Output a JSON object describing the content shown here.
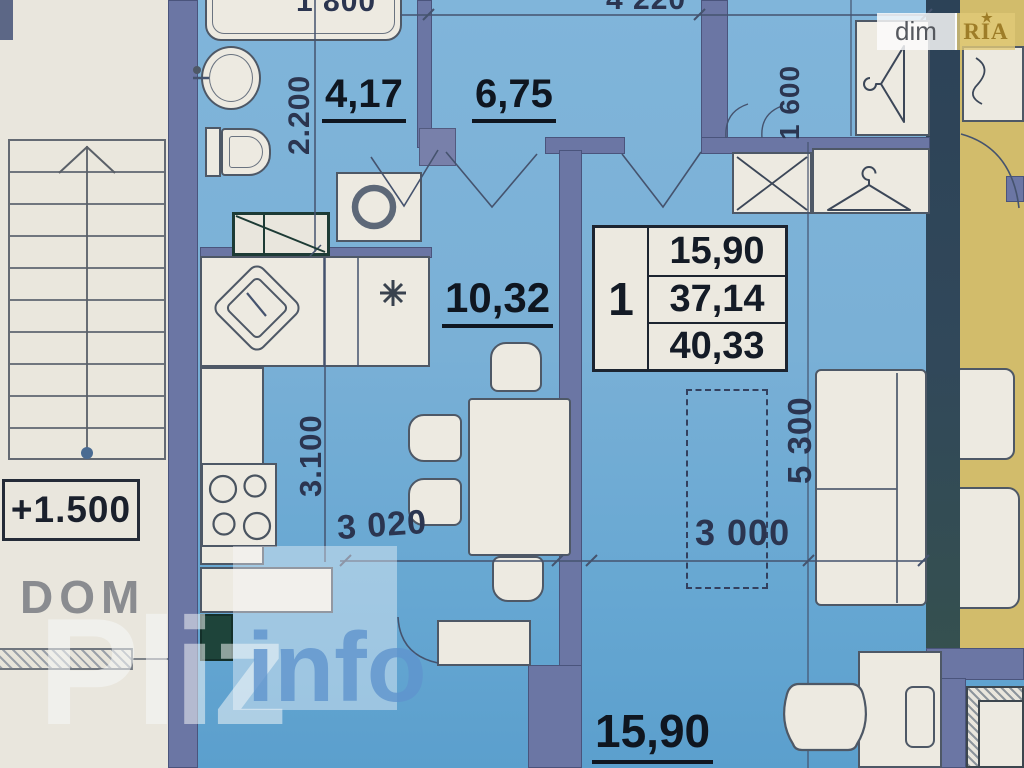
{
  "plan": {
    "type": "apartment-floor-plan",
    "rooms": {
      "bathroom": {
        "area": "4,17"
      },
      "hall": {
        "area": "6,75"
      },
      "kitchen": {
        "area": "10,32"
      },
      "living_room": {
        "area": "15,90"
      }
    },
    "info_table": {
      "rooms_count": "1",
      "rows": [
        "15,90",
        "37,14",
        "40,33"
      ]
    },
    "stairs": {
      "level_label": "+1.500"
    },
    "dimensions": {
      "bathtub_width": "1 800",
      "top_total_width": "4 220",
      "bathroom_depth": "2.200",
      "closet_width": "1 600",
      "kitchen_depth": "3.100",
      "kitchen_width": "3 020",
      "living_width": "3 000",
      "living_depth": "5 300"
    }
  },
  "watermark": {
    "dom": "DOM",
    "pliz": "Pliz",
    "info": "info"
  },
  "logo": {
    "dim": "dim",
    "ria": "RIA",
    "star": "★"
  },
  "colors": {
    "floor_blue": "#74aed6",
    "wall_slate": "#6b76a4",
    "wall_dark": "#2f4558",
    "neighbor_yellow": "#d2bc6b",
    "paper_white": "#e9e6dd",
    "label_text": "#0f1620",
    "dim_text": "#2b3550",
    "watermark_blue": "#5f93cd",
    "vent_green": "#1e443a"
  }
}
